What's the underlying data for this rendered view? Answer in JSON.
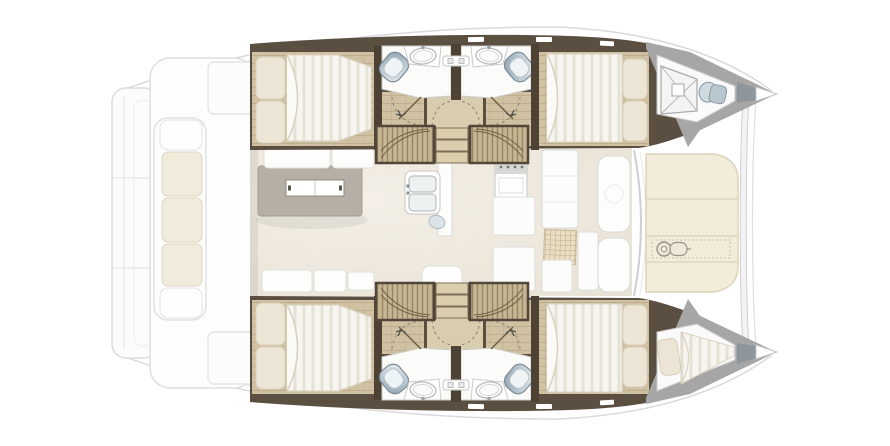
{
  "floorplan": {
    "subject": "catamaran sailing yacht interior layout, top-down plan view",
    "orientation": "bow-right-stern-left",
    "cabins": 4,
    "bathrooms": 4,
    "hulls": [
      {
        "id": "top-hull",
        "rooms": [
          {
            "name": "aft-double-cabin",
            "fixtures": [
              "double-berth",
              "pillow",
              "pillow",
              "wood-floor"
            ]
          },
          {
            "name": "aft-bathroom",
            "fixtures": [
              "toilet",
              "washbasin",
              "vanity-shelf",
              "door-swing"
            ]
          },
          {
            "name": "forward-bathroom",
            "fixtures": [
              "toilet",
              "washbasin",
              "vanity-shelf",
              "door-swing"
            ]
          },
          {
            "name": "forward-double-cabin",
            "fixtures": [
              "double-berth",
              "pillow",
              "pillow",
              "wood-floor"
            ]
          },
          {
            "name": "forepeak",
            "fixtures": [
              "escape-hatch",
              "sea-toilet"
            ]
          }
        ]
      },
      {
        "id": "bottom-hull",
        "rooms": [
          {
            "name": "aft-double-cabin",
            "fixtures": [
              "double-berth",
              "pillow",
              "pillow",
              "wood-floor"
            ]
          },
          {
            "name": "aft-bathroom",
            "fixtures": [
              "toilet",
              "washbasin",
              "vanity-shelf",
              "door-swing"
            ]
          },
          {
            "name": "forward-bathroom",
            "fixtures": [
              "toilet",
              "washbasin",
              "vanity-shelf",
              "door-swing"
            ]
          },
          {
            "name": "forward-double-cabin",
            "fixtures": [
              "double-berth",
              "pillow",
              "pillow",
              "wood-floor"
            ]
          },
          {
            "name": "forepeak-berth",
            "fixtures": [
              "single-berth",
              "pillow"
            ]
          }
        ]
      }
    ],
    "bridgedeck": {
      "saloon": {
        "fixtures": [
          "dining-table",
          "table-centerpiece",
          "bench-cushions-aft",
          "bench-cushions-forward",
          "side-table"
        ]
      },
      "galley": {
        "fixtures": [
          "double-sink",
          "faucet",
          "bar-basin",
          "stove-top",
          "worktop",
          "lower-cabinet",
          "tall-cabinet",
          "floor-hatch-grate",
          "forward-seat-cushions"
        ]
      },
      "companionways": {
        "fixtures": [
          "port-stair-hatch",
          "starboard-stair-hatch",
          "central-steps",
          "landing"
        ]
      }
    },
    "exterior": {
      "aft": [
        "transom-steps",
        "aft-cockpit-outline",
        "cockpit-sofa",
        "cream-sofa-cushions",
        "cockpit-lockers"
      ],
      "forward": [
        "foredeck-lounge-cushions",
        "windlass",
        "forward-crossbeam",
        "bow-fittings"
      ],
      "style": "ghosted light gray linework"
    },
    "palette": {
      "wall_dark": "#5b4f41",
      "bulkhead": "#4d4234",
      "wood_floor": "#cfc1a2",
      "landing_wood": "#d9cdaf",
      "stair_hatch": "#c6b691",
      "step_tread": "#dbcead",
      "mattress": "#f7f5f0",
      "pillow": "#ede5d5",
      "bathroom_floor": "#fbfbfa",
      "toilet_blue": "#8fa3b2",
      "saloon_floor": "#efe9df",
      "table_gray": "#b6afa5",
      "cream_cushion": "#f2edda",
      "forepeak_wall": "#a6a6a6",
      "bow_fitting": "#8f969b",
      "ghost_line": "#dadadd",
      "mesh_hatch": "#e9dec4"
    }
  }
}
